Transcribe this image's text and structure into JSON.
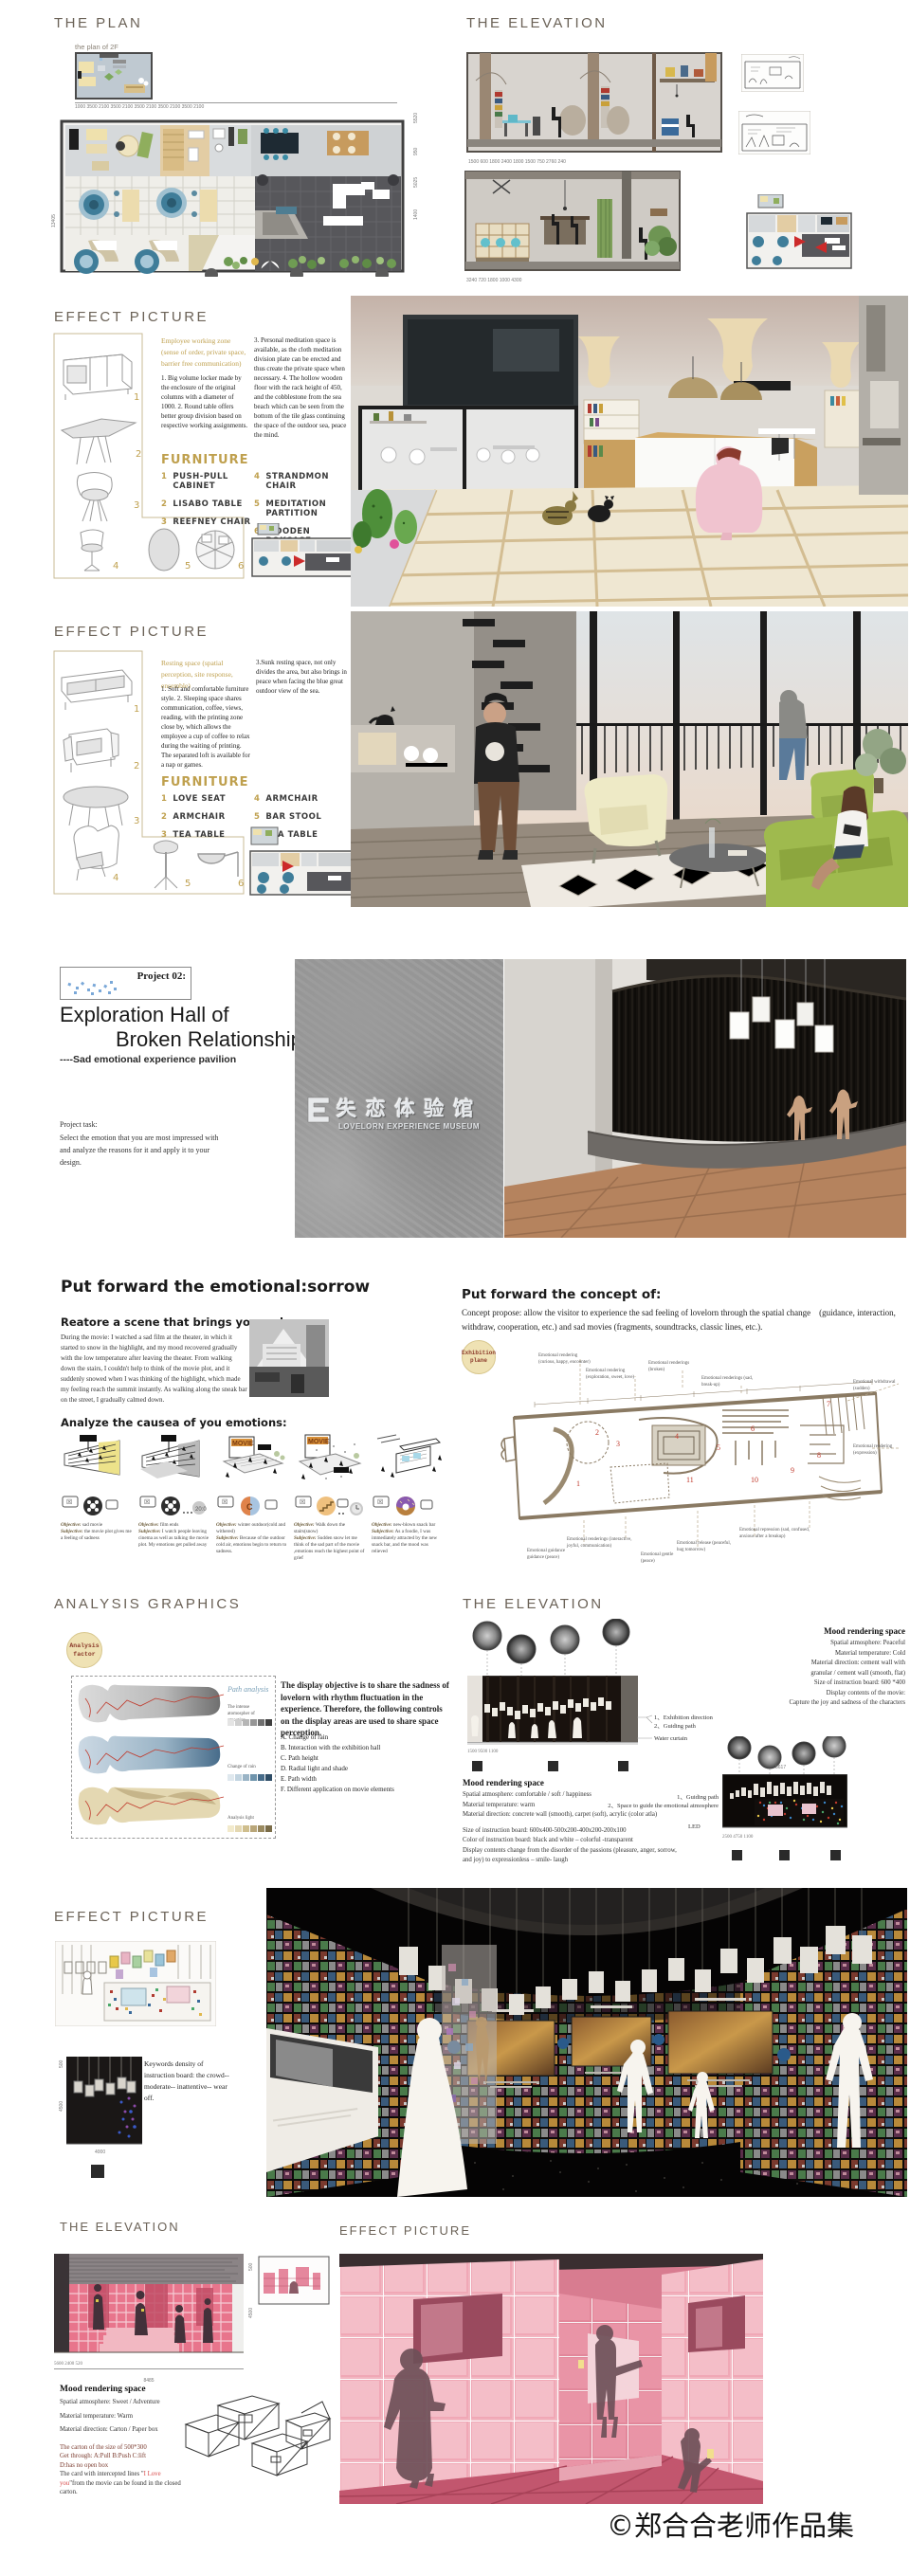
{
  "page": {
    "copyright": "©郑合合老师作品集"
  },
  "plan": {
    "title": "THE PLAN",
    "sub_label": "the plan of 2F",
    "dims_top": "1000   3500   2100   3500   2100   3500   2100   3500   2100   3500   2100",
    "dim_left": "13405",
    "dims_right": [
      "5520",
      "950",
      "5025",
      "1400"
    ]
  },
  "elevation_top": {
    "title": "THE ELEVATION",
    "dims_elev1": "1500  600  1800  2400  1800  1500  750  2760  240",
    "dims_elev2": "3240   720   1800   1000   4300"
  },
  "effect1": {
    "title": "EFFECT PICTURE",
    "zone_title": "Employee working zone (sense of order, private space, barrier free communication)",
    "para_left": "1. Big volume locker made by the enclosure of the original columns with a diameter of 1000. 2. Round table offers better group division based on respective working assignments.",
    "para_right": "3. Personal meditation space is available, as the cloth meditation division plate can be erected and thus create the private space when necessary. 4. The hollow wooden floor with the rack height of 450, and the cobblestone from the sea beach which can be seen from the bottom of the tile glass continuing the space of the outdoor sea, peace the mind.",
    "furniture_title": "FURNITURE",
    "items": [
      {
        "num": "1",
        "label": "PUSH-PULL CABINET"
      },
      {
        "num": "2",
        "label": "LISABO TABLE"
      },
      {
        "num": "3",
        "label": "REEFNEY CHAIR"
      },
      {
        "num": "4",
        "label": "STRANDMON CHAIR"
      },
      {
        "num": "5",
        "label": "MEDITATION PARTITION"
      },
      {
        "num": "6",
        "label": "WOODEN BOKCASE"
      }
    ]
  },
  "effect2": {
    "title": "EFFECT PICTURE",
    "zone_title": "Resting space (spatial perception, site response, ensemble)",
    "para_left": "1. Soft and comfortable furniture style. 2. Sleeping space shares communication, coffee, views, reading, with the printing zone close by, which allows the employee a cup of coffee to relax during the waiting of printing. The separated loft is available for a nap or games.",
    "para_right": "3.Sunk resting space, not only divides the area, but also brings in peace when facing the blue great outdoor view of the sea.",
    "furniture_title": "FURNITURE",
    "items": [
      {
        "num": "1",
        "label": "LOVE SEAT"
      },
      {
        "num": "2",
        "label": "ARMCHAIR"
      },
      {
        "num": "3",
        "label": "TEA TABLE"
      },
      {
        "num": "4",
        "label": "ARMCHAIR"
      },
      {
        "num": "5",
        "label": "BAR STOOL"
      },
      {
        "num": "6",
        "label": "TEA TABLE"
      }
    ]
  },
  "project2": {
    "badge": "Project 02:",
    "title1": "Exploration Hall of",
    "title2": "Broken Relationship",
    "subtitle": "----Sad emotional experience pavilion",
    "task_title": "Project task:",
    "task_text": "Select the emotion that you are most impressed with and analyze the reasons for it and apply it to your design.",
    "wall_cn": "失 恋 体 验 馆",
    "wall_en": "LOVELORN EXPERIENCE MUSEUM"
  },
  "emotional": {
    "title": "Put forward the emotional:sorrow",
    "restore_title": "Reatore a scene that brings you sadness:",
    "restore_text": "During the movie: I watched a sad film at the theater, in which it started to snow in the highlight, and my mood recovered gradually with the low temperature after leaving the theater. From walking down the stairs, I couldn't help to think of the movie plot, and it suddenly snowed when I was thinking of the highlight, which made my feeling reach the summit instantly. As walking along the sneak bar on the street, I gradually calmed down.",
    "analyze_title": "Analyze the causea of you emotions:",
    "obj_word": "Objective:",
    "subj_word": "Subjective:",
    "cards": [
      {
        "objective": "sad movie",
        "subjective": "the movie plot gives me a feeling of sadness"
      },
      {
        "objective": "film ends",
        "subjective": "I watch people leaving cinema as well as talking the movie plot. My emotions get pulled away"
      },
      {
        "objective": "winter outdoor(cold and withered)",
        "subjective": "Because of the outdoor cold air, emotions begin to return to sadness."
      },
      {
        "objective": "Walk down the stairs(snow)",
        "subjective": "Sudden snow let me think of the sad part of the movie ,emotions reach the highest point of grief"
      },
      {
        "objective": "new-blown snack bar",
        "subjective": "As a foodie, I was immediately attracted by the new snack bar, and the mood was relieved"
      }
    ]
  },
  "concept": {
    "title": "Put forward the concept of:",
    "text": "Concept propose: allow the visitor to experience the sad feeling of lovelorn through the spatial change　(guidance, interaction, withdraw, cooperation, etc.) and sad movies (fragments, soundtracks, classic lines, etc.).",
    "badge_line1": "Exhibition",
    "badge_line2": "plane",
    "numbers": [
      "1",
      "2",
      "3",
      "4",
      "5",
      "6",
      "7",
      "8",
      "9",
      "10",
      "11"
    ],
    "labels_top": [
      "Emotional rendering (curious, happy, encounter)",
      "Emotional rendering (exploration, sweet, love)",
      "Emotional renderings (broken)",
      "Emotional renderings (sad, break-up)"
    ],
    "labels_right": [
      "Emotional withdrawal (sudden)",
      "Emotional rendering (expression)"
    ],
    "labels_bottom": [
      "Emotional guidance guidance (peace)",
      "Emotional renderings (interactive, joyful, communication)",
      "Emotional gentle (peace)",
      "Emotional release (peaceful, hug tomorrow)",
      "Emotional repression (sad, confused, anxious after a breakup)"
    ]
  },
  "analysis": {
    "title": "ANALYSIS GRAPHICS",
    "badge_line1": "Analysis",
    "badge_line2": "factor",
    "path_label": "Path analysis",
    "legend1": "The intense atomospher of emoution",
    "legend2": "Change of rain",
    "legend3": "Analysis light",
    "objective_text": "The display objective is to share the sadness of lovelorn with rhythm fluctuation in the experience. Therefore, the following controls on the display areas are used to share space perception.",
    "list": [
      "A. Change of rain",
      "B. Interaction with the exhibition hall",
      "C. Path height",
      "D. Radial light and shade",
      "E. Path width",
      "F. Different application on movie elements"
    ]
  },
  "elevation_mid": {
    "title": "THE ELEVATION",
    "mood1_title": "Mood rendering space",
    "mood1_lines": [
      "Spatial atmosphere: Peaceful",
      "Material temperature: Cold",
      "Material direction: cement wall with",
      "granular / cement wall (smooth, flat)",
      "Size of instruction board:  600 *400",
      "Display contents of the movie:",
      "Capture the joy and sadness of the characters"
    ],
    "elev1_labels": [
      "1、Exhibition direction",
      "2、Guiding path",
      "Water curtain"
    ],
    "elev1_dims": "1500                9500                1100",
    "mood2_title": "Mood rendering space",
    "mood2_lines": [
      "Spatial atmosphere: comfortable / soft / happiness",
      "Material temperature: warm",
      "Material direction: concrete wall (smooth), carpet (soft), acrylic (color atla)",
      "Size of instruction board:  600x400-500x200-400x200-200x100",
      "Color of instruction board: black and white – colorful -transparent",
      "Display contents change from the disorder of the passions (pleasure, anger, sorrow, and joy) to expressionless – smile- laugh"
    ],
    "elev2_labels": [
      "1、Guiding path",
      "2、Space to guide the emotional atmosphere",
      "LED"
    ],
    "elev2_dim_top": "8617",
    "elev2_dims": "2500         4750         1100"
  },
  "effect3": {
    "title": "EFFECT PICTURE",
    "keywords_text": "Keywords density of instruction board: the crowd--moderate-- inattentive-- wear off.",
    "dim_500": "500",
    "dim_4500": "4500",
    "dim_4000": "4000"
  },
  "elevation_bottom": {
    "title": "THE ELEVATION",
    "mood_title": "Mood rendering space",
    "mood_lines": [
      "Spatial atmosphere:  Sweet / Adventure",
      "Material temperature:  Warm",
      "Material direction: Carton / Paper box"
    ],
    "carton_lines": [
      "The carton of the size of 500*300",
      "Get through: A:Pull   B:Push   C:lift",
      "D:has no open box"
    ],
    "card_pre": "The card with intercepted lines \"",
    "card_red": "I Love you",
    "card_post": "\"from the movie can be found in the closed carton.",
    "dim_500": "500",
    "dim_4500": "4500",
    "dims_bottom": "5600              2400        520",
    "dim_total": "8485"
  },
  "effect4": {
    "title": "EFFECT PICTURE"
  }
}
